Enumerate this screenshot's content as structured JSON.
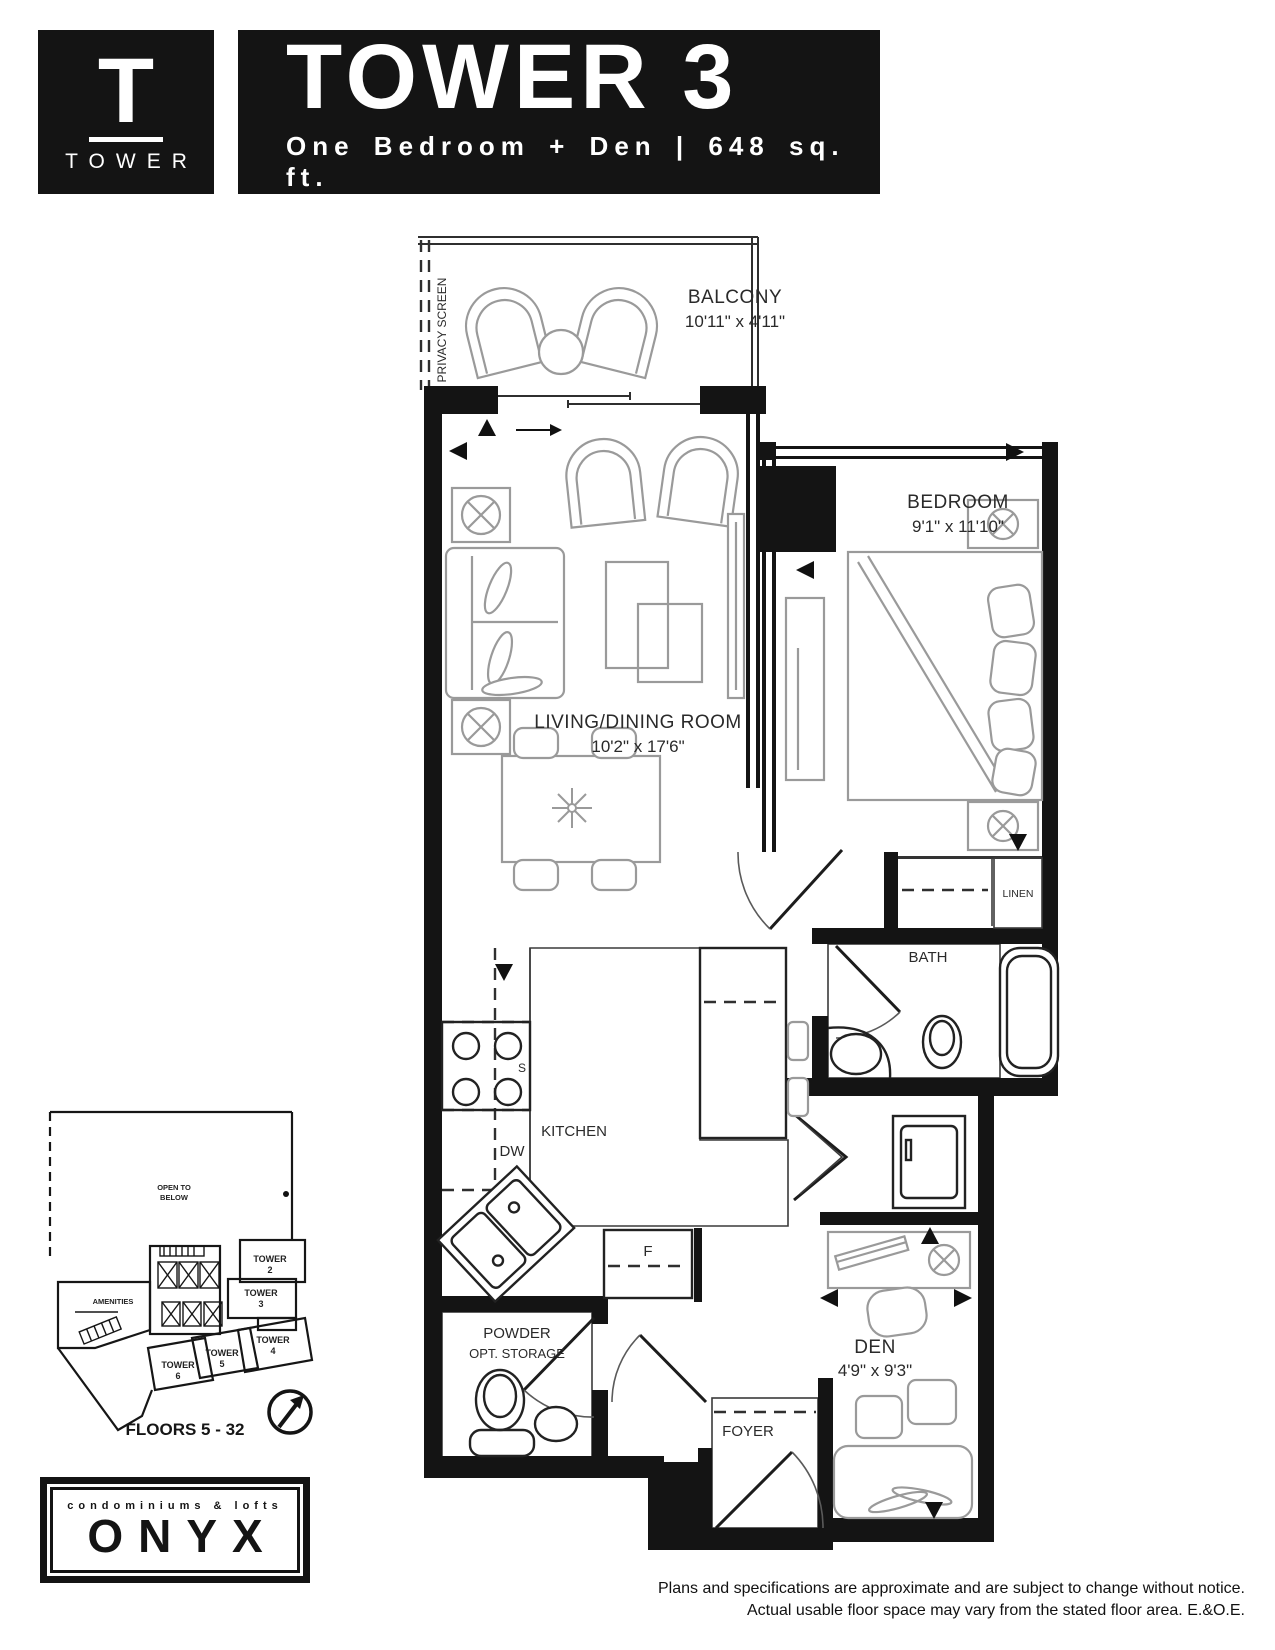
{
  "header": {
    "logo_letter": "T",
    "logo_label": "TOWER",
    "title": "TOWER 3",
    "subtitle": "One Bedroom + Den  |  648 sq. ft."
  },
  "plan": {
    "privacy_screen": "PRIVACY SCREEN",
    "balcony_name": "BALCONY",
    "balcony_dims": "10'11\" x 4'11\"",
    "living_name": "LIVING/DINING ROOM",
    "living_dims": "10'2\" x 17'6\"",
    "bedroom_name": "BEDROOM",
    "bedroom_dims": "9'1\" x 11'10\"",
    "bath_name": "BATH",
    "linen": "LINEN",
    "kitchen_name": "KITCHEN",
    "stove": "S",
    "dishwasher": "DW",
    "fridge": "F",
    "powder_name": "POWDER",
    "powder_sub": "OPT. STORAGE",
    "foyer_name": "FOYER",
    "den_name": "DEN",
    "den_dims": "4'9\" x 9'3\""
  },
  "keyplan": {
    "open_to_below_1": "OPEN TO",
    "open_to_below_2": "BELOW",
    "amenities": "AMENITIES",
    "towers": [
      {
        "label": "TOWER",
        "num": "2"
      },
      {
        "label": "TOWER",
        "num": "3"
      },
      {
        "label": "TOWER",
        "num": "4"
      },
      {
        "label": "TOWER",
        "num": "5"
      },
      {
        "label": "TOWER",
        "num": "6"
      }
    ],
    "floors": "FLOORS 5 - 32",
    "highlight_color": "#c7a98c"
  },
  "branding": {
    "tagline": "condominiums & lofts",
    "name": "ONYX"
  },
  "disclaimer": {
    "line1": "Plans and specifications are approximate and are subject to change without notice.",
    "line2": "Actual usable floor space may vary from the stated floor area. E.&O.E."
  }
}
